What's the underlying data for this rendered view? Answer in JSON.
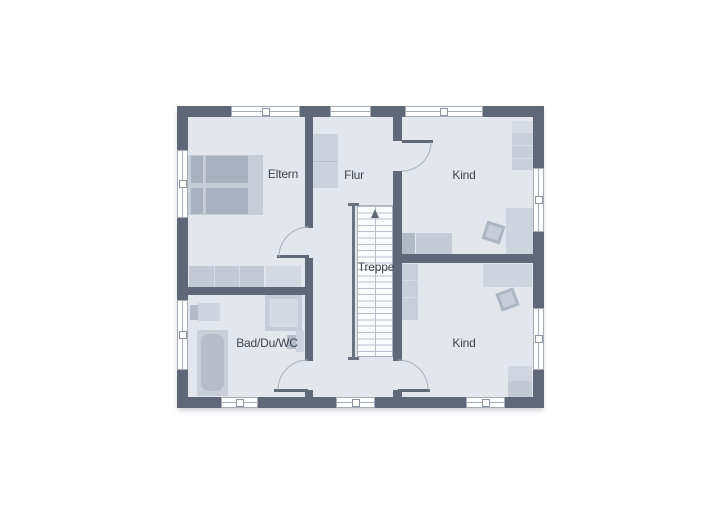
{
  "plan": {
    "type": "floor-plan-upper-storey",
    "labels": [
      {
        "id": "eltern",
        "text": "Eltern"
      },
      {
        "id": "flur",
        "text": "Flur"
      },
      {
        "id": "kind-top",
        "text": "Kind"
      },
      {
        "id": "treppe",
        "text": "Treppe"
      },
      {
        "id": "bad",
        "text": "Bad/Du/WC"
      },
      {
        "id": "kind-bottom",
        "text": "Kind"
      }
    ],
    "rooms": [
      {
        "label_ref": "eltern",
        "furniture": [
          "double-bed",
          "wardrobe",
          "cabinet"
        ]
      },
      {
        "label_ref": "flur",
        "furniture": [
          "cabinet"
        ]
      },
      {
        "label_ref": "kind-top",
        "furniture": [
          "wardrobe",
          "desk",
          "chair",
          "bed"
        ]
      },
      {
        "label_ref": "treppe",
        "furniture": [
          "staircase-up"
        ]
      },
      {
        "label_ref": "bad",
        "furniture": [
          "washbasin",
          "bathtub",
          "shower",
          "wc"
        ]
      },
      {
        "label_ref": "kind-bottom",
        "furniture": [
          "wardrobe",
          "desk",
          "chair",
          "bed"
        ]
      }
    ],
    "window_count": 10,
    "door_count": 4,
    "stairs_direction": "up",
    "colors": {
      "page_bg": "#ffffff",
      "wall": "#5f6878",
      "room_fill": "#e3e6ed",
      "window_frame": "#a6adb9",
      "arc_line": "#a8afba",
      "stair_fill": "#fafbfc",
      "tread_line": "#b9bfca",
      "rail": "#6a7382",
      "label": "#3d4553",
      "furn_light": "#ced4de",
      "furn_mid": "#c5cbd6",
      "furn_dark": "#a9b1c0",
      "furn_frame": "#c7cdd7"
    }
  }
}
